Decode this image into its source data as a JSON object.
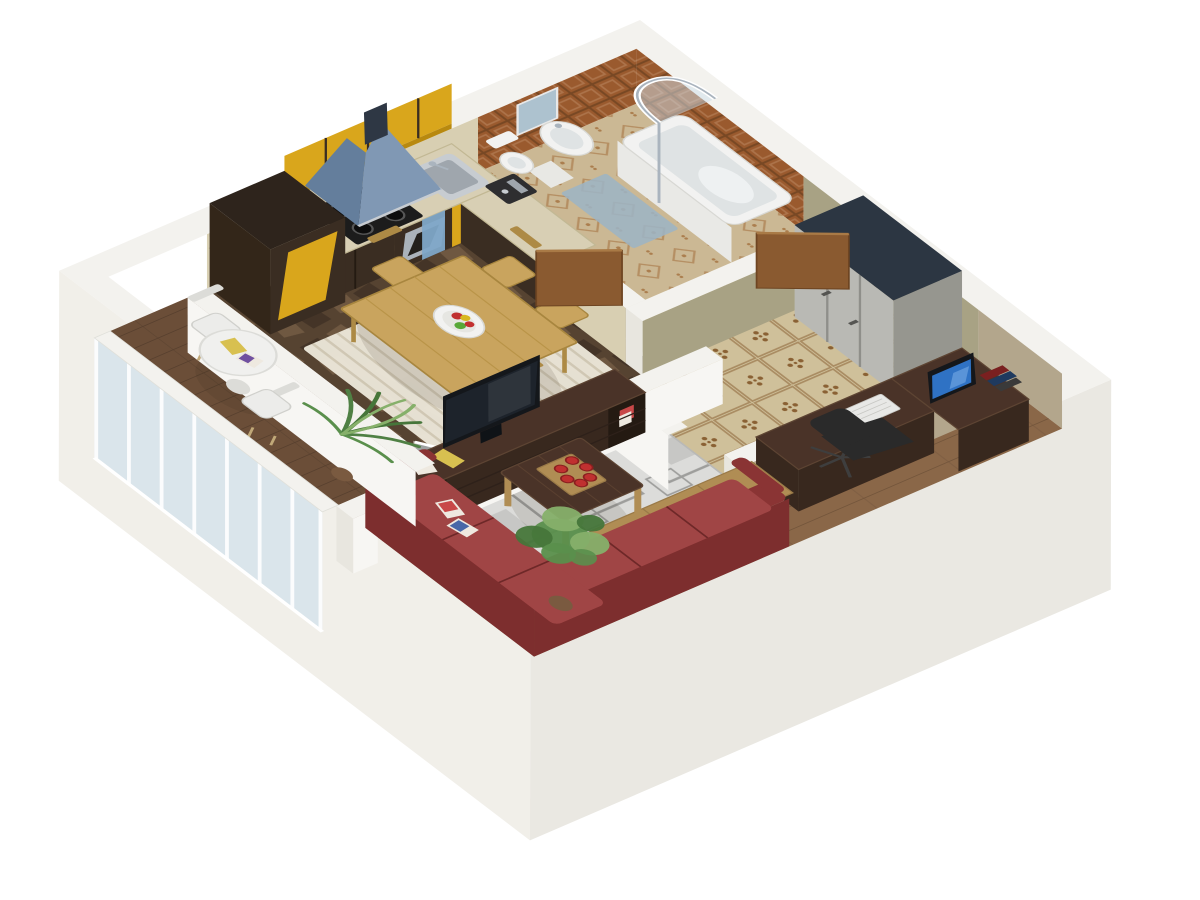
{
  "scene": {
    "type": "3d-apartment-floor-plan-render",
    "view": "isometric-top-down",
    "background": "#ffffff",
    "rooms": [
      {
        "name": "kitchen-dining",
        "floor": "dark-stone-tile",
        "items": [
          "base-cabinets",
          "tall-cabinet",
          "upper-cabinets",
          "extractor-hood",
          "cooktop",
          "oven",
          "kitchen-sink",
          "coffee-machine",
          "dish-towel",
          "dining-table",
          "fruit-bowl",
          "dining-chair-1",
          "dining-chair-2",
          "dining-chair-3",
          "dining-chair-4",
          "striped-rug"
        ]
      },
      {
        "name": "bathroom",
        "floor": "patterned-beige-tile",
        "items": [
          "bathtub",
          "shower-enclosure",
          "pedestal-sink",
          "mirror",
          "toilet",
          "bath-mat",
          "bathroom-door"
        ]
      },
      {
        "name": "hallway",
        "floor": "ornament-tile",
        "items": [
          "wardrobe",
          "entry-door"
        ]
      },
      {
        "name": "living-room",
        "floor": "wood-planks",
        "items": [
          "corner-sofa",
          "sofa-magazines",
          "coffee-table",
          "serving-tray",
          "red-cups",
          "tv-console",
          "tv",
          "area-rug",
          "balcony-glass-door"
        ]
      },
      {
        "name": "office-nook",
        "floor": "wood-planks",
        "items": [
          "l-shaped-desk",
          "monitor",
          "keyboard",
          "desk-books",
          "office-chair",
          "sideboard",
          "potted-plant"
        ]
      },
      {
        "name": "balcony",
        "floor": "dark-wood-planks",
        "items": [
          "round-table",
          "balcony-chair-1",
          "balcony-chair-2",
          "palm-plant",
          "table-magazines",
          "glass-balustrade"
        ]
      }
    ]
  },
  "palette": {
    "bg": "#ffffff",
    "wallTop": "#f3f2ee",
    "wallFaceLight": "#f7f6f3",
    "wallFaceShade": "#e8e6df",
    "outerFaceBL": "#f1efe9",
    "outerFaceBR": "#eae8e2",
    "oliveWall": "#a8a284",
    "tanWall": "#b3a68c",
    "beigeWall": "#d8cfb2",
    "bathTileBrown": "#9a5a2e",
    "bathTileGrout": "#784824",
    "bathFloorBase": "#cbb894",
    "bathFloorMotif": "#ab7e4e",
    "matBlue": "#9db4c4",
    "hallTileBase": "#cfc09a",
    "hallTileMotif": "#8a6134",
    "stoneBase": "#564331",
    "stoneLight": "#6f5841",
    "stoneDark": "#443427",
    "woodFloor": "#8a6748",
    "woodFloorLine": "#73553b",
    "balconyFloor": "#6b4e38",
    "balconyFloorLine": "#58402e",
    "rugBase": "#dcdcda",
    "rugLine": "#9e9e9c",
    "rugFill": "#c7c7c5",
    "stripeBase": "#ece7d9",
    "stripeLine": "#d5cdb9",
    "counterTop": "#d8cfb4",
    "cabinetDark": "#3a2d22",
    "cabinetDarker": "#2e241c",
    "cabinetSide": "#332619",
    "yellowDoor": "#d9a61c",
    "yellowShade": "#b8890f",
    "steel": "#c7ccd1",
    "steelDark": "#9fa6ad",
    "ovenSteel": "#aab2ba",
    "ovenGlass": "#23201c",
    "hoodBlue": "#8098b4",
    "hoodBlueDark": "#647e9c",
    "hoodChimney": "#2e3744",
    "stoveBlack": "#1c1c1c",
    "burner": "#0d0d0d",
    "burnerRing": "#565656",
    "towelBlue": "#7fa8c8",
    "oakLight": "#c9a45e",
    "oakShade": "#ad8a45",
    "fixtureWhite": "#f2f2f1",
    "fixtureShade": "#dfe3e4",
    "tubFace": "#e9e9e6",
    "sinkPedestal": "#e8e8e4",
    "glassBlue": "#cfe0ec",
    "chrome": "#aab4be",
    "mirrorBlue": "#adc2cf",
    "doorWood": "#8a5a30",
    "doorWoodLight": "#a97a46",
    "doorWoodDark": "#6e4522",
    "wardrobeFront": "#b9b9b4",
    "wardrobeSide": "#96968f",
    "wardrobeTop": "#2c3642",
    "walnut": "#4a3328",
    "walnutFace": "#38281e",
    "walnutLight": "#5d4433",
    "cubbyDark": "#241a12",
    "trayWood": "#b08d54",
    "sofaRed": "#a04545",
    "sofaRedDark": "#8a3434",
    "sofaRedDeep": "#7d2e2e",
    "sofaSeam": "#6e2828",
    "cupRed": "#c03030",
    "cupRim": "#8a1f1f",
    "monitorBlue": "#2f72c4",
    "monitorLight": "#7db0ea",
    "bezel": "#14171b",
    "screenDark": "#1d232b",
    "chairBlack": "#2a2a2a",
    "chairBase": "#3e3e3e",
    "plantGreen": "#5a8f4c",
    "plantLight": "#86b06a",
    "plantDark": "#46763a",
    "palmGreen": "#4f8044",
    "potBrown": "#7a5a40",
    "tableWhite": "#f0f0ee",
    "chairWhite": "#ececea",
    "chairWhiteShade": "#dcdcd8",
    "legTan": "#c0a878",
    "keyboardWhite": "#e8e8e6",
    "bookRed": "#7a2020",
    "bookNavy": "#1f3a5f",
    "bookGray": "#3a3a3a",
    "magWhite": "#eee9e0",
    "magRed": "#c84848",
    "magBlue": "#4868a8",
    "magYellow": "#d8c050",
    "magPurple": "#7050a0",
    "shadow": "rgba(50,38,28,0.12)"
  }
}
